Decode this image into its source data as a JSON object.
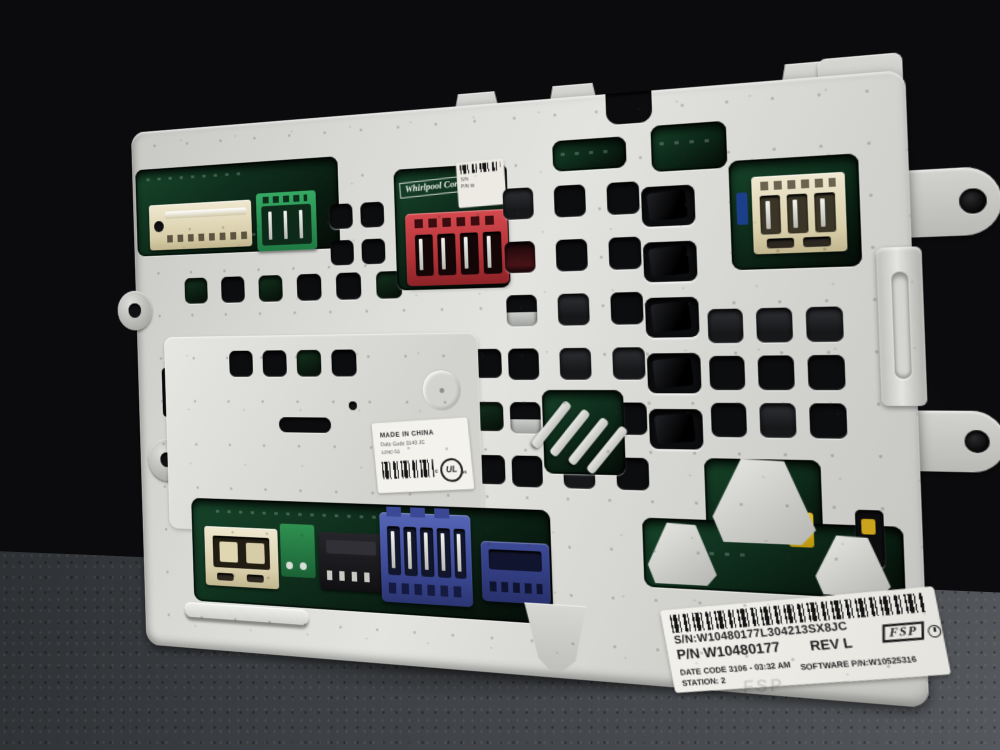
{
  "scene": {
    "subject": "Whirlpool laundry appliance electronic control board in white plastic cover, photographed on a dark textured surface"
  },
  "pcb": {
    "brand": "Whirlpool Corp."
  },
  "top_partial_label": {
    "line1": "S/N",
    "line2": "P/N W"
  },
  "sticker": {
    "line1": "MADE IN CHINA",
    "line2": "Date Code 3143  JC",
    "line3": "L0NC-53",
    "ul_prefix": "c",
    "ul_mark": "UL",
    "ul_suffix": "us"
  },
  "main_label": {
    "serial": "S/N:W10480177L304213SX8JC",
    "part_number": "P/N W10480177",
    "revision": "REV L",
    "date_code": "DATE CODE 3106 - 03:32 AM",
    "station": "STATION: 2",
    "software": "SOFTWARE P/N:W10525316",
    "fsp": "FSP",
    "embossed": "FSP"
  },
  "colors": {
    "cover": "#d6d5d1",
    "pcb_green": "#1c6f42",
    "connector_red": "#c03a3f",
    "connector_blue": "#41519f",
    "connector_beige": "#e7decc",
    "connector_green": "#2f9e5c",
    "connector_black": "#17171a",
    "floor": "#45484c",
    "background": "#0b0b0d",
    "yellow_component": "#d8b022"
  }
}
